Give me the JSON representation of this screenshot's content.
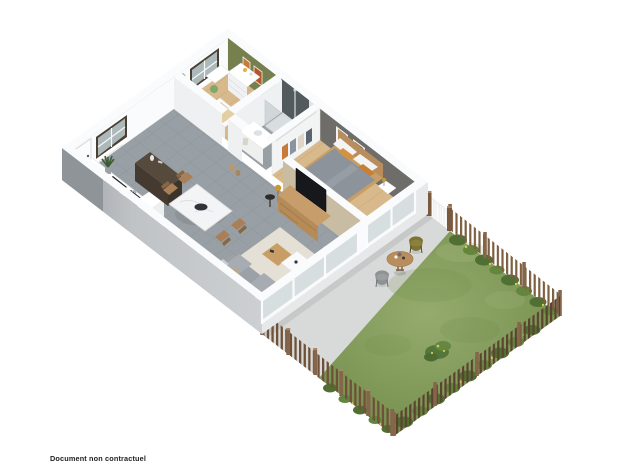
{
  "caption": {
    "text": "Document non contractuel"
  },
  "scene": {
    "description": "3D isometric floor plan render: apartment with living-kitchen, child bedroom, bathroom, master bedroom, terrace and fenced garden lawn",
    "rooms": [
      "living-kitchen",
      "child-bedroom",
      "bathroom",
      "bedroom",
      "terrace",
      "garden"
    ]
  },
  "colors": {
    "background": "#ffffff",
    "caption_color": "#222222",
    "wall_white": "#fafbfc",
    "wall_face_light": "#eef0f1",
    "wall_face_mid": "#c2c6c9",
    "wall_face_dark": "#8f9498",
    "wall_se_face": "#e6e8e9",
    "accent_green": "#76804e",
    "accent_gray": "#6e6d69",
    "accent_tan": "#c8bca2",
    "tile": "#99a0a5",
    "tile_line": "#8b9297",
    "wood": "#d8b98c",
    "wood_line": "#c7a474",
    "wood_dark": "#b98d5c",
    "terrace": "#d8dad9",
    "lawn_light": "#95ab6e",
    "lawn_dark": "#6f8a47",
    "lawn_mid": "#849e59",
    "hedge": "#4f6f33",
    "hedge_light": "#64853e",
    "flower": "#d9c94f",
    "fence_sw": "#6e5138",
    "fence_ne": "#7d5f42",
    "fence_se": "#5a432f",
    "post": "#85664a",
    "post_top": "#a8886a",
    "glass": "#c7d4d6",
    "frame_dark": "#4a3f33",
    "sofa": "#9ba1a6",
    "sofa_dark": "#8d9399",
    "rug": "#e9e4d7",
    "marble": "#f3f4f6",
    "walnut": "#564a3d",
    "walnut_dark": "#443a30",
    "tv": "#16181b",
    "duvet": "#8d939a",
    "pillow": "#f4f4f4",
    "pillow_orange": "#d1933f",
    "gold": "#c8972f"
  }
}
